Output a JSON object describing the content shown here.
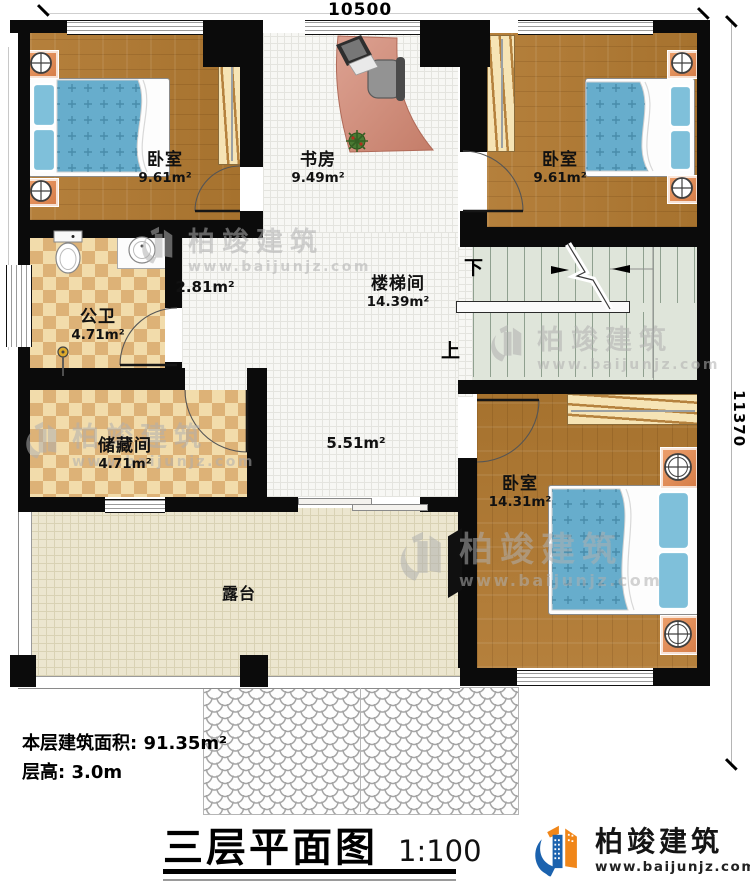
{
  "title_block": {
    "title": "三层平面图",
    "scale": "1:100"
  },
  "brand": {
    "name": "柏竣建筑",
    "website": "www.baijunjz.com"
  },
  "watermark": {
    "name": "柏竣建筑",
    "website": "www.baijunjz.com"
  },
  "dimensions": {
    "width": "10500",
    "height": "11370"
  },
  "notes": {
    "floor_area": "本层建筑面积: 91.35m²",
    "floor_height": "层高: 3.0m"
  },
  "rooms": {
    "bedroom1": {
      "name": "卧室",
      "area": "9.61m²"
    },
    "study": {
      "name": "书房",
      "area": "9.49m²"
    },
    "bedroom2": {
      "name": "卧室",
      "area": "9.61m²"
    },
    "bathroom": {
      "name": "公卫",
      "area": "4.71m²"
    },
    "corridor": {
      "area": "2.81m²"
    },
    "stairwell": {
      "name": "楼梯间",
      "area": "14.39m²"
    },
    "storage": {
      "name": "储藏间",
      "area": "4.71m²"
    },
    "hall": {
      "area": "5.51m²"
    },
    "bedroom3": {
      "name": "卧室",
      "area": "14.31m²"
    },
    "terrace": {
      "name": "露台"
    }
  },
  "stairs": {
    "down_label": "下",
    "up_label": "上"
  },
  "colors": {
    "logo_blue": "#1b62ae",
    "logo_orange": "#f08619"
  }
}
